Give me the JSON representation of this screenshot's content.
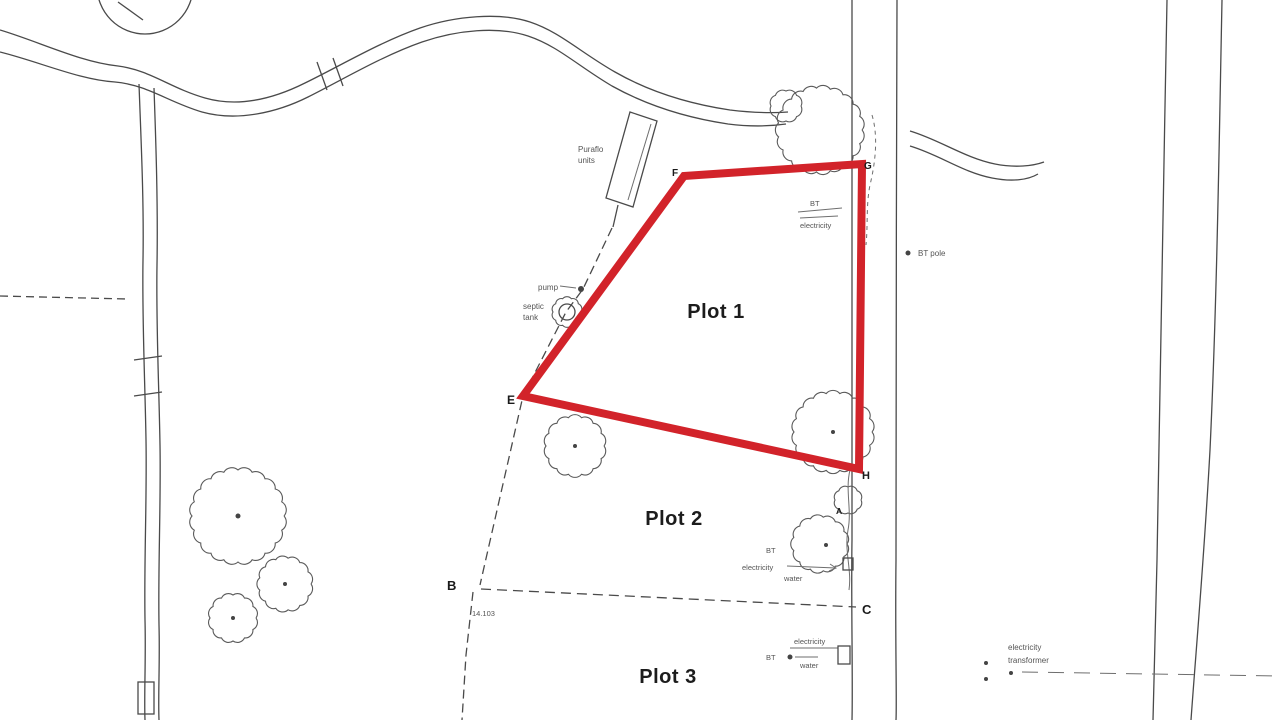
{
  "plots": {
    "plot1": "Plot 1",
    "plot2": "Plot 2",
    "plot3": "Plot 3"
  },
  "labels": {
    "puraflo1": "Puraflo",
    "puraflo2": "units",
    "pump": "pump",
    "septic1": "septic",
    "septic2": "tank",
    "bt_pole": "BT pole",
    "bt_top": "BT",
    "electricity_top": "electricity",
    "bt_mid": "BT",
    "electricity_mid": "electricity",
    "water_mid": "water",
    "electricity_bottom": "electricity",
    "bt_bottom": "BT",
    "water_bottom": "water",
    "transformer1": "electricity",
    "transformer2": "transformer",
    "dim_b": "14.103"
  },
  "markers": {
    "a": "A",
    "b": "B",
    "c": "C",
    "e": "E",
    "f": "F",
    "g": "G",
    "h": "H"
  },
  "colors": {
    "boundary": "#d2232a",
    "ink": "#4a4a4a"
  }
}
